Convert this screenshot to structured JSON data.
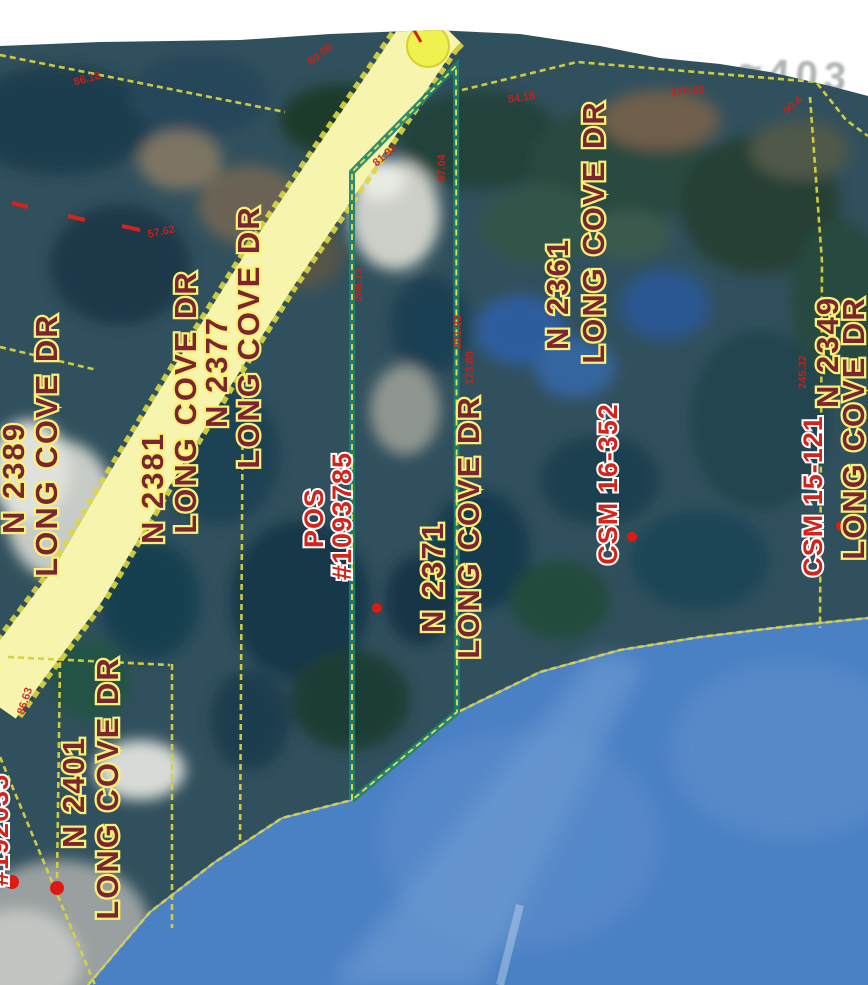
{
  "map": {
    "parcels": [
      {
        "address": "N 2389",
        "street": "LONG COVE DR"
      },
      {
        "address": "N 2401",
        "street": "LONG COVE DR"
      },
      {
        "address": "N 2381",
        "street": "LONG COVE DR"
      },
      {
        "address": "N 2377",
        "street": "LONG COVE DR"
      },
      {
        "address": "N 2371",
        "street": "LONG COVE DR"
      },
      {
        "address": "N 2361",
        "street": "LONG COVE DR"
      },
      {
        "address": "N 2349",
        "street": "LONG COVE DR"
      }
    ],
    "pos_label": {
      "line1": "POS",
      "line2": "#1093785"
    },
    "csm_labels": [
      {
        "text": "CSM 16-352"
      },
      {
        "text": "CSM 15-121"
      }
    ],
    "partial_label_left_edge": "#192035",
    "scan_artifact_text": "≈403",
    "dimensions": [
      {
        "text": "86.18"
      },
      {
        "text": "80.06"
      },
      {
        "text": "84.18"
      },
      {
        "text": "170.90"
      },
      {
        "text": "90.4"
      },
      {
        "text": "57.62"
      },
      {
        "text": "81.93"
      },
      {
        "text": "67.04"
      },
      {
        "text": "209.13"
      },
      {
        "text": "201.92"
      },
      {
        "text": "173.85"
      },
      {
        "text": "245.32"
      },
      {
        "text": "86.63"
      }
    ],
    "colors": {
      "water": "#4a80c4",
      "road_fill": "#f7f5ad",
      "parcel_line_yellow": "#d8d23a",
      "highlight_green": "#1c8070",
      "address_text": "#7b2433",
      "address_halo": "#f7f176",
      "survey_red": "#d6231a",
      "node_dot_yellow": "#eff14f"
    }
  }
}
